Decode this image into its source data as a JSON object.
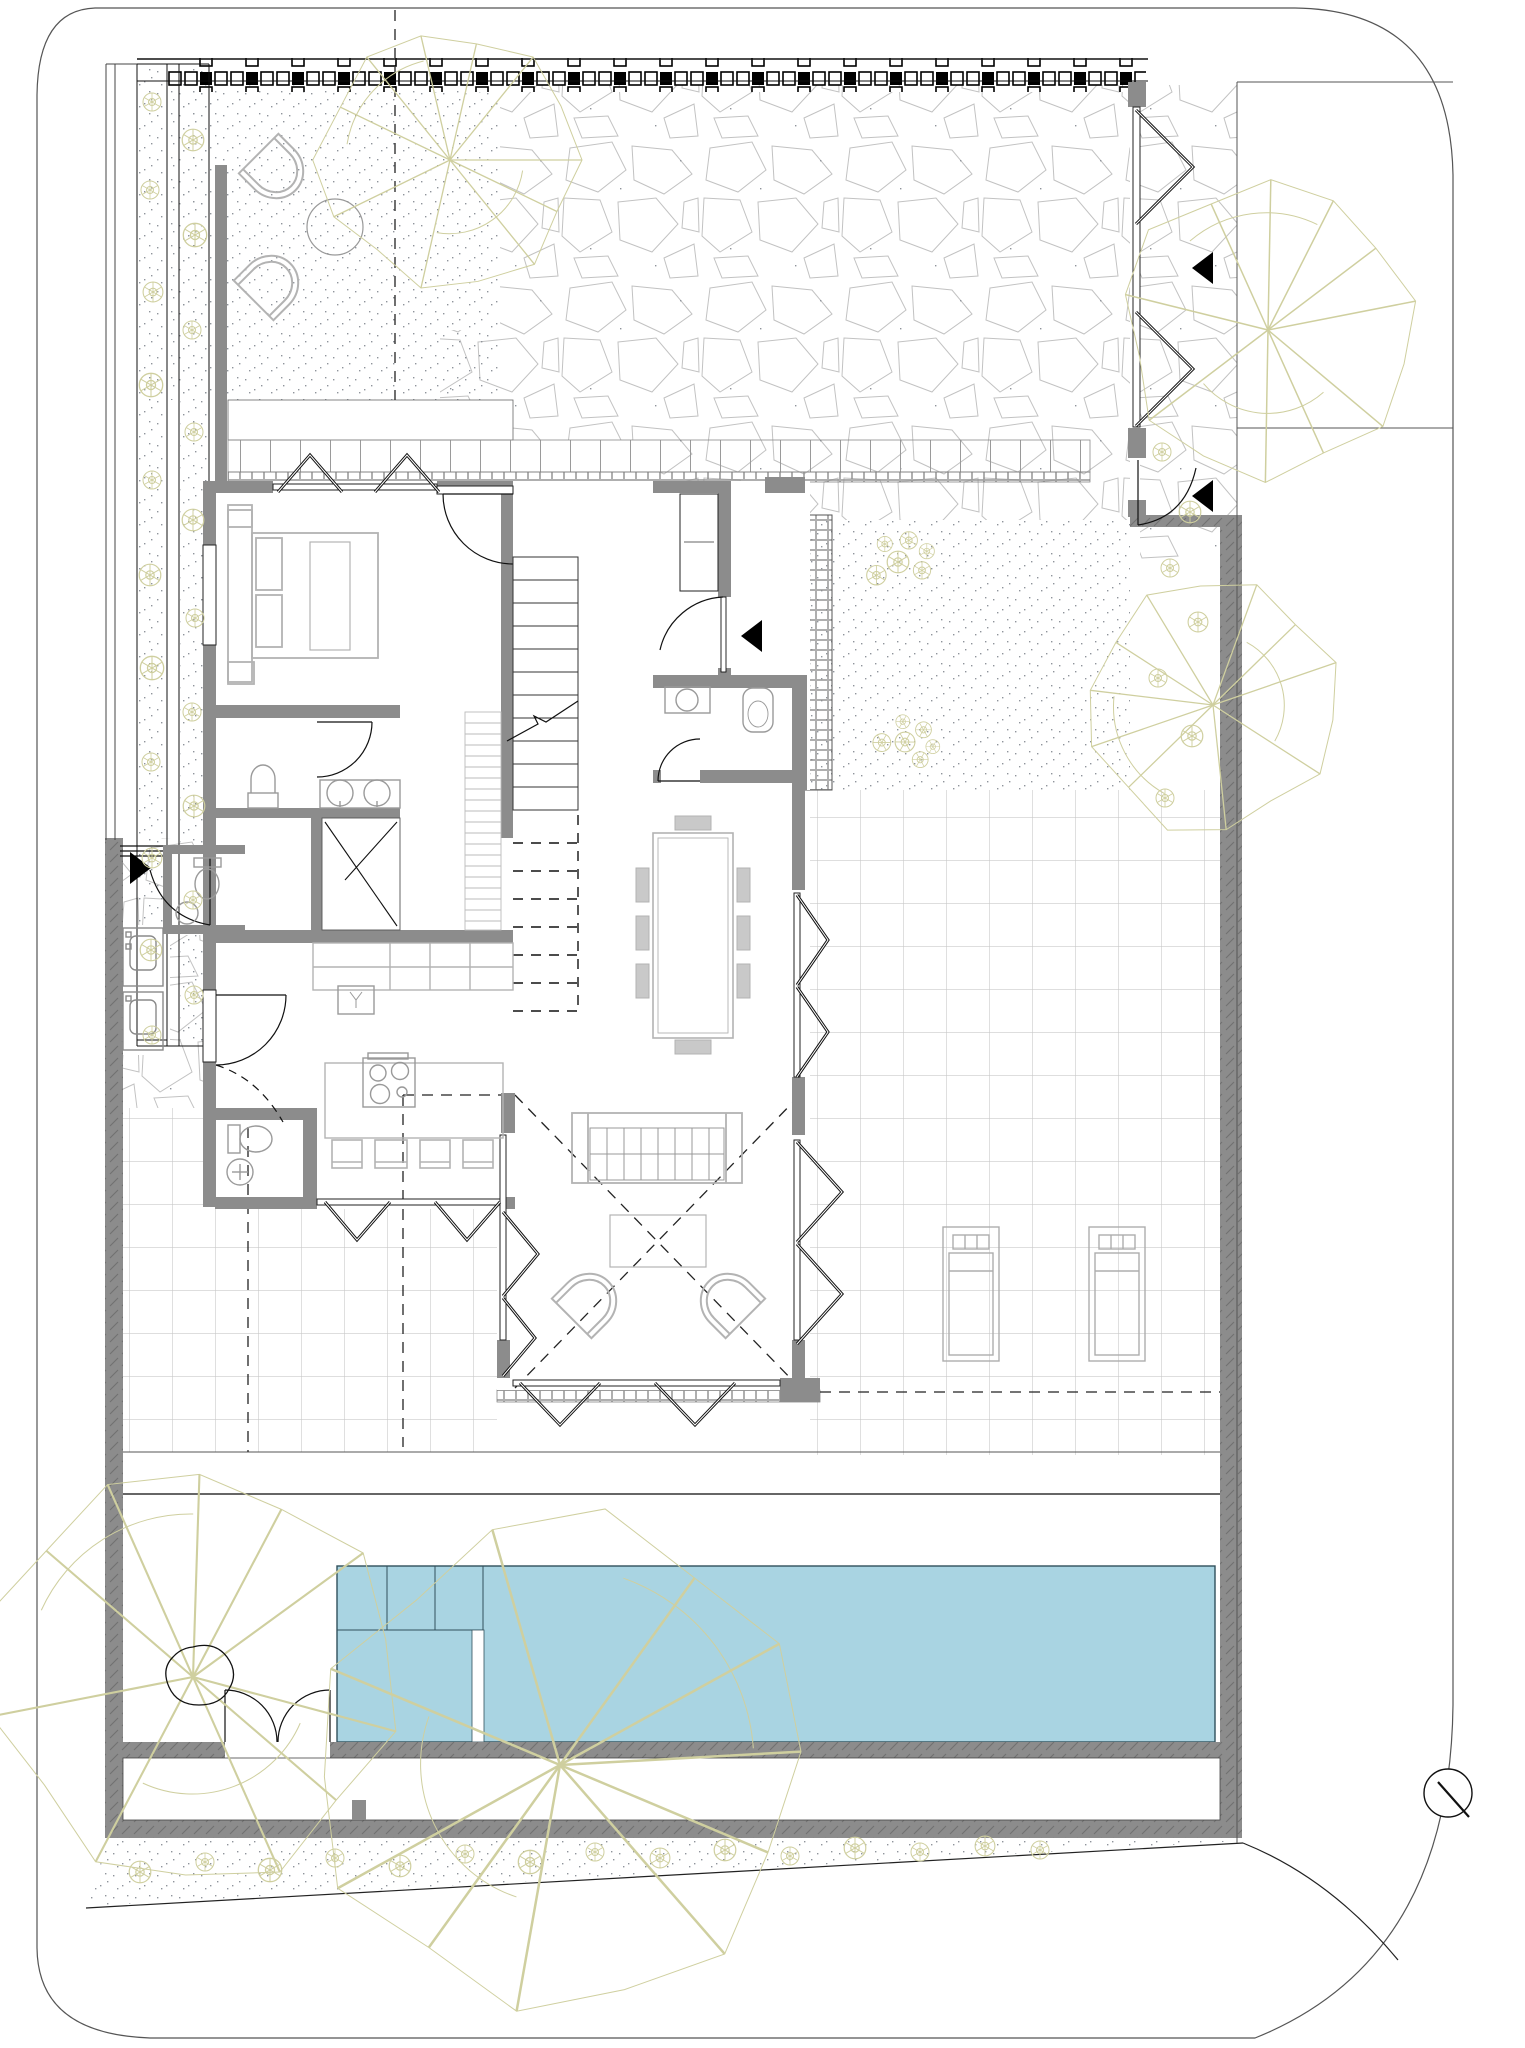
{
  "drawing": {
    "kind": "architectural ground-floor site plan",
    "visible_text": "none",
    "orientation_marker": "north-arrow-bottom-right"
  },
  "colors": {
    "paper": "#ffffff",
    "wall": "#8c8c8c",
    "wall_tick": "#6f6f6f",
    "line": "#1a1a1a",
    "boundary": "#555555",
    "furniture": "#b3b3b3",
    "fixture": "#9a9a9a",
    "tile_line": "#c9c9c9",
    "stone_line": "#c2c2c2",
    "stipple": "#8f949b",
    "plant": "#cfcf9f",
    "pool_fill": "#a9d4e2",
    "pool_edge": "#31505c",
    "deck_line": "#9a9a9a"
  },
  "inventory": {
    "swimming_pool": 1,
    "double_bed": 1,
    "dining_table": 1,
    "dining_chairs": 8,
    "kitchen_island": 1,
    "cooktop_burners": 4,
    "bar_stools": 4,
    "sofa": 1,
    "coffee_table": 1,
    "wicker_armchairs": 2,
    "garden_chairs": 2,
    "garden_table": 1,
    "sun_loungers": 2,
    "toilets": 4,
    "washbasins": 8,
    "showers": 1,
    "staircase_flights": 2,
    "entry_arrows": 4,
    "folding_door_bays": 16,
    "gates": 3,
    "large_trees": 5,
    "planting_strips": 2
  },
  "north_arrow": {
    "present": true
  }
}
